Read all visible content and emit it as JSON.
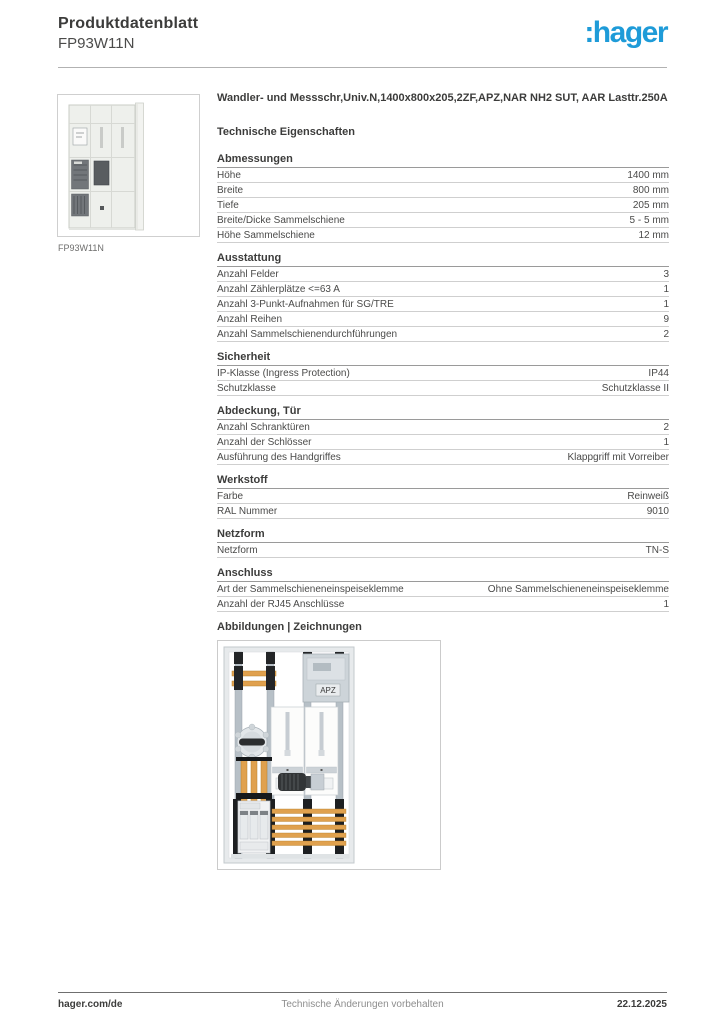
{
  "header": {
    "doc_type": "Produktdatenblatt",
    "product_code": "FP93W11N"
  },
  "logo": {
    "text": ":hager",
    "color": "#1e9bd8"
  },
  "product": {
    "title": "Wandler- und Messschr,Univ.N,1400x800x205,2ZF,APZ,NAR NH2 SUT, AAR Lasttr.250A",
    "image_caption": "FP93W11N"
  },
  "tech": {
    "heading": "Technische Eigenschaften"
  },
  "sections": [
    {
      "heading": "Abmessungen",
      "rows": [
        {
          "label": "Höhe",
          "value": "1400 mm"
        },
        {
          "label": "Breite",
          "value": "800 mm"
        },
        {
          "label": "Tiefe",
          "value": "205 mm"
        },
        {
          "label": "Breite/Dicke Sammelschiene",
          "value": "5 - 5 mm"
        },
        {
          "label": "Höhe Sammelschiene",
          "value": "12 mm"
        }
      ]
    },
    {
      "heading": "Ausstattung",
      "rows": [
        {
          "label": "Anzahl Felder",
          "value": "3"
        },
        {
          "label": "Anzahl Zählerplätze <=63 A",
          "value": "1"
        },
        {
          "label": "Anzahl 3-Punkt-Aufnahmen für SG/TRE",
          "value": "1"
        },
        {
          "label": "Anzahl Reihen",
          "value": "9"
        },
        {
          "label": "Anzahl Sammelschienendurchführungen",
          "value": "2"
        }
      ]
    },
    {
      "heading": "Sicherheit",
      "rows": [
        {
          "label": "IP-Klasse (Ingress Protection)",
          "value": "IP44"
        },
        {
          "label": "Schutzklasse",
          "value": "Schutzklasse II"
        }
      ]
    },
    {
      "heading": "Abdeckung, Tür",
      "rows": [
        {
          "label": "Anzahl Schranktüren",
          "value": "2"
        },
        {
          "label": "Anzahl der Schlösser",
          "value": "1"
        },
        {
          "label": "Ausführung des Handgriffes",
          "value": "Klappgriff mit Vorreiber"
        }
      ]
    },
    {
      "heading": "Werkstoff",
      "rows": [
        {
          "label": "Farbe",
          "value": "Reinweiß"
        },
        {
          "label": "RAL Nummer",
          "value": "9010"
        }
      ]
    },
    {
      "heading": "Netzform",
      "rows": [
        {
          "label": "Netzform",
          "value": "TN-S"
        }
      ]
    },
    {
      "heading": "Anschluss",
      "rows": [
        {
          "label": "Art der Sammelschieneneinspeiseklemme",
          "value": "Ohne Sammelschieneneinspeiseklemme"
        },
        {
          "label": "Anzahl der RJ45 Anschlüsse",
          "value": "1"
        }
      ]
    }
  ],
  "figures": {
    "heading": "Abbildungen | Zeichnungen",
    "apz_label": "APZ"
  },
  "footer": {
    "left": "hager.com/de",
    "center": "Technische Änderungen vorbehalten",
    "right": "22.12.2025"
  },
  "colors": {
    "accent_blue": "#1e9bd8",
    "busbar_orange": "#e0a14e",
    "text": "#3c3c3b",
    "rule_light": "#cfcfcf",
    "rule_dark": "#6f6f6f"
  }
}
